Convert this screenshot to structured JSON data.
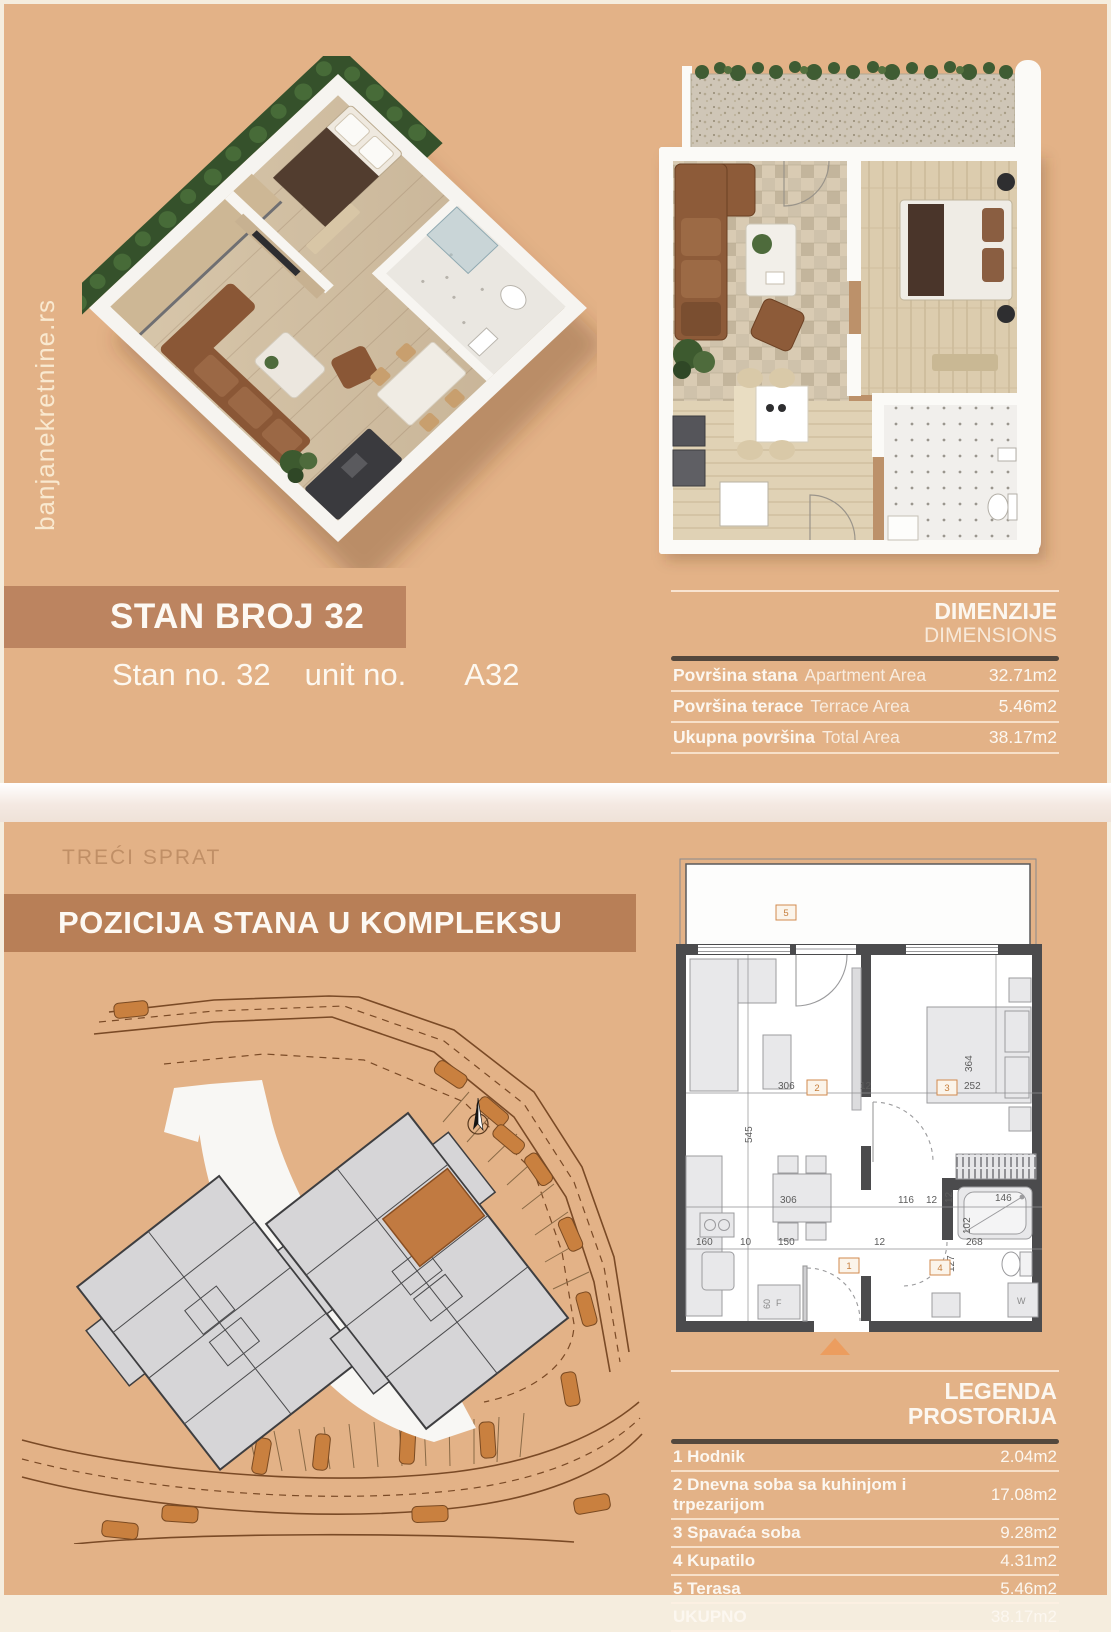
{
  "watermark": "banjanekretnine.rs",
  "top_section": {
    "title": "STAN BROJ 32",
    "subtitle": {
      "stan": "Stan no. 32",
      "unit": "unit no.",
      "code": "A32"
    },
    "dimensions_table": {
      "heading_primary": "DIMENZIJE",
      "heading_secondary": "DIMENSIONS",
      "rows": [
        {
          "label": "Površina stana",
          "label_en": "Apartment Area",
          "value": "32.71m2"
        },
        {
          "label": "Površina terace",
          "label_en": "Terrace Area",
          "value": "5.46m2"
        },
        {
          "label": "Ukupna površina",
          "label_en": "Total Area",
          "value": "38.17m2"
        }
      ]
    }
  },
  "bottom_section": {
    "floor_label": "TREĆI SPRAT",
    "section_title": "POZICIJA STANA U KOMPLEKSU",
    "legend_table": {
      "heading_primary": "LEGENDA",
      "heading_secondary": "PROSTORIJA",
      "rows": [
        {
          "label": "1 Hodnik",
          "value": "2.04m2"
        },
        {
          "label": "2 Dnevna soba sa kuhinjom i trpezarijom",
          "value": "17.08m2"
        },
        {
          "label": "3 Spavaća soba",
          "value": "9.28m2"
        },
        {
          "label": "4 Kupatilo",
          "value": "4.31m2"
        },
        {
          "label": "5 Terasa",
          "value": "5.46m2"
        },
        {
          "label": "UKUPNO",
          "value": "38.17m2"
        }
      ]
    }
  },
  "tech_plan": {
    "room_tags": {
      "hall": "1",
      "living": "2",
      "bedroom": "3",
      "bath": "4",
      "terrace": "5"
    },
    "dims": {
      "a306": "306",
      "a12": "12",
      "a252": "252",
      "a364": "364",
      "a545": "545",
      "b306": "306",
      "b116": "116",
      "b12": "12",
      "b146": "146",
      "b102": "102",
      "b12v": "12",
      "c160": "160",
      "c10": "10",
      "c150": "150",
      "c12": "12",
      "c268": "268",
      "c127": "127"
    },
    "appliances": {
      "fridge_width": "60",
      "fridge": "F",
      "washer": "W"
    }
  },
  "colors": {
    "background": "#e3b287",
    "title_bar": "#bc8460",
    "position_bar": "#b87f57",
    "rule_dark": "#54483d",
    "text_light": "#fcf7f0",
    "muted_label": "#c08f66",
    "wall_dark": "#4b4b4d",
    "accent_orange": "#d9884a",
    "car_orange": "#c9803f",
    "building_gray": "#d6d5d7"
  }
}
